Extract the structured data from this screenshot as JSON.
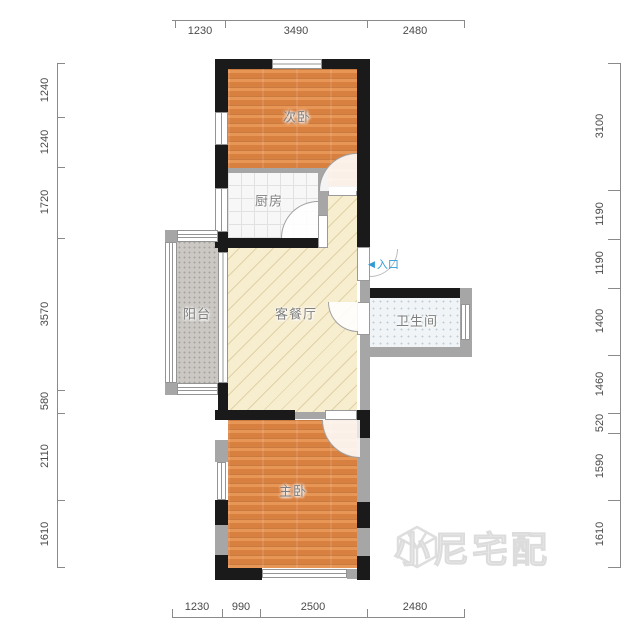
{
  "plan": {
    "rooms": {
      "secondary_bedroom": "次卧",
      "kitchen": "厨房",
      "living_dining": "客餐厅",
      "balcony": "阳台",
      "bathroom": "卫生间",
      "master_bedroom": "主卧"
    },
    "entrance": {
      "arrow": "◀",
      "label": "入口"
    }
  },
  "dims": {
    "top": [
      "1230",
      "3490",
      "2480"
    ],
    "bottom": [
      "1230",
      "990",
      "2500",
      "2480"
    ],
    "left": [
      "1240",
      "1240",
      "1720",
      "3570",
      "580",
      "2110",
      "1610"
    ],
    "right": [
      "3100",
      "1190",
      "1190",
      "1400",
      "1460",
      "520",
      "1590",
      "1610"
    ]
  },
  "watermark": {
    "text": "小尼宅配"
  },
  "colors": {
    "wall_black": "#1a1a1a",
    "wall_gray": "#a6a6a6",
    "wood_floor": "#dd8647",
    "living_floor": "#f7edcf",
    "balcony_floor": "#cbc8c3",
    "bathroom_floor": "#f0f4f6",
    "entrance_blue": "#2f9bd6"
  }
}
